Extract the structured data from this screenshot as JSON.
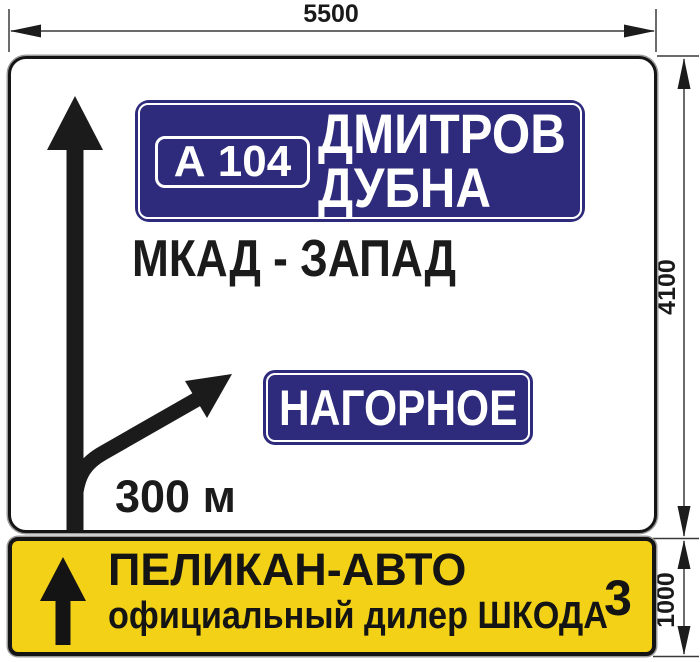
{
  "dimensions": {
    "width_label": "5500",
    "sign_height_label": "4100",
    "panel_height_label": "1000"
  },
  "main_sign": {
    "destination_panel": {
      "route_badge": "А 104",
      "destinations": [
        "ДМИТРОВ",
        "ДУБНА"
      ]
    },
    "road_name": "МКАД - ЗАПАД",
    "branch_panel": "НАГОРНОЕ",
    "distance": "300 м"
  },
  "dealer_panel": {
    "name": "ПЕЛИКАН-АВТО",
    "subtitle": "официальный дилер ШКОДА",
    "route_number": "3"
  },
  "colors": {
    "panel_blue": "#2e2a7c",
    "panel_yellow": "#f2d117",
    "ink": "#161616",
    "dimension_line": "#3a3a3a"
  }
}
